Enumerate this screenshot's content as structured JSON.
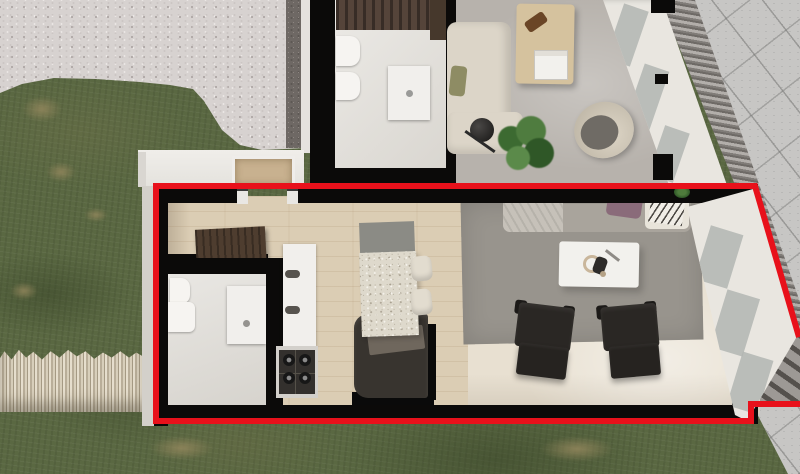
{
  "scene": {
    "kind": "3d-floor-plan-render",
    "view": "top-down bird's eye",
    "description": "Photorealistic top-down render of two adjoining apartment units; the lower unit is traced with a red highlight outline, surrounded by lawn, a gravel patio, a firewood stack and a paved walkway.",
    "highlight_outline_color": "#e8111b"
  },
  "palette": {
    "grass": "#5a6842",
    "dirt_patch": "#91865c",
    "gravel": "#d7d2d0",
    "gravel_edge": "#6e6864",
    "firewood": "#d8cfbb",
    "pavement": "#c7c6c4",
    "drainage_grate": "#807c78",
    "wall": "#0b0a09",
    "outline": "#e8111b",
    "wood_floor": "#dbcdb4",
    "stone_floor": "#e8e0d1",
    "bathroom_floor": "#e3e0db",
    "gray_floor": "#b7b2ac",
    "rug": "#98948d",
    "sofa_highlighted_unit": "#a9a49c",
    "sofa_neighbor_unit": "#dcd5c8",
    "armchair": "#2a2724",
    "island_terrazzo": "#ded9cc",
    "console_wood": "#4e3d2f",
    "window_frame": "#e9e6e0",
    "glass": "#b2b5b2"
  },
  "highlighted_apartment": {
    "outlined": true,
    "outline_color": "#e8111b",
    "rooms": [
      {
        "name": "entry-hall",
        "floor": "wood",
        "furniture": [
          "console-dresser",
          "entry-door-thresholds"
        ]
      },
      {
        "name": "bathroom",
        "floor": "stone",
        "furniture": [
          "toilet",
          "vanity",
          "washbasin-cabinet"
        ]
      },
      {
        "name": "kitchen",
        "floor": "wood",
        "furniture": [
          "cabinet-column",
          "gas-stove",
          "kitchen-island",
          "bar-stool-1",
          "bar-stool-2",
          "dark-sideboard"
        ]
      },
      {
        "name": "living-room",
        "floor": "stone",
        "furniture": [
          "area-rug",
          "sofa",
          "throw-blanket",
          "purple-pillow",
          "magazine-stack",
          "coffee-table",
          "armchair-left",
          "armchair-right",
          "small-plant"
        ]
      }
    ],
    "window_wall": "angled glazing along right facade with black wall stubs"
  },
  "neighbor_apartment": {
    "outlined": false,
    "rooms": [
      {
        "name": "bathroom",
        "floor": "stone",
        "furniture": [
          "vanity-counter",
          "toilet",
          "bidet",
          "washbasin-cabinet"
        ]
      },
      {
        "name": "living-room",
        "floor": "gray-screed",
        "furniture": [
          "corner-sofa",
          "olive-pillow",
          "coffee-table",
          "book-stack",
          "floor-lamp",
          "potted-plant",
          "hanging-egg-chair"
        ]
      }
    ],
    "window_wall": "angled glazing along right facade"
  },
  "environment": {
    "features": [
      "lawn",
      "dirt-patches",
      "gravel-patio",
      "gravel-dark-edging",
      "firewood-stack",
      "white-ledge-with-rooflight",
      "paved-walkway",
      "drainage-grate",
      "exterior-steps"
    ]
  }
}
